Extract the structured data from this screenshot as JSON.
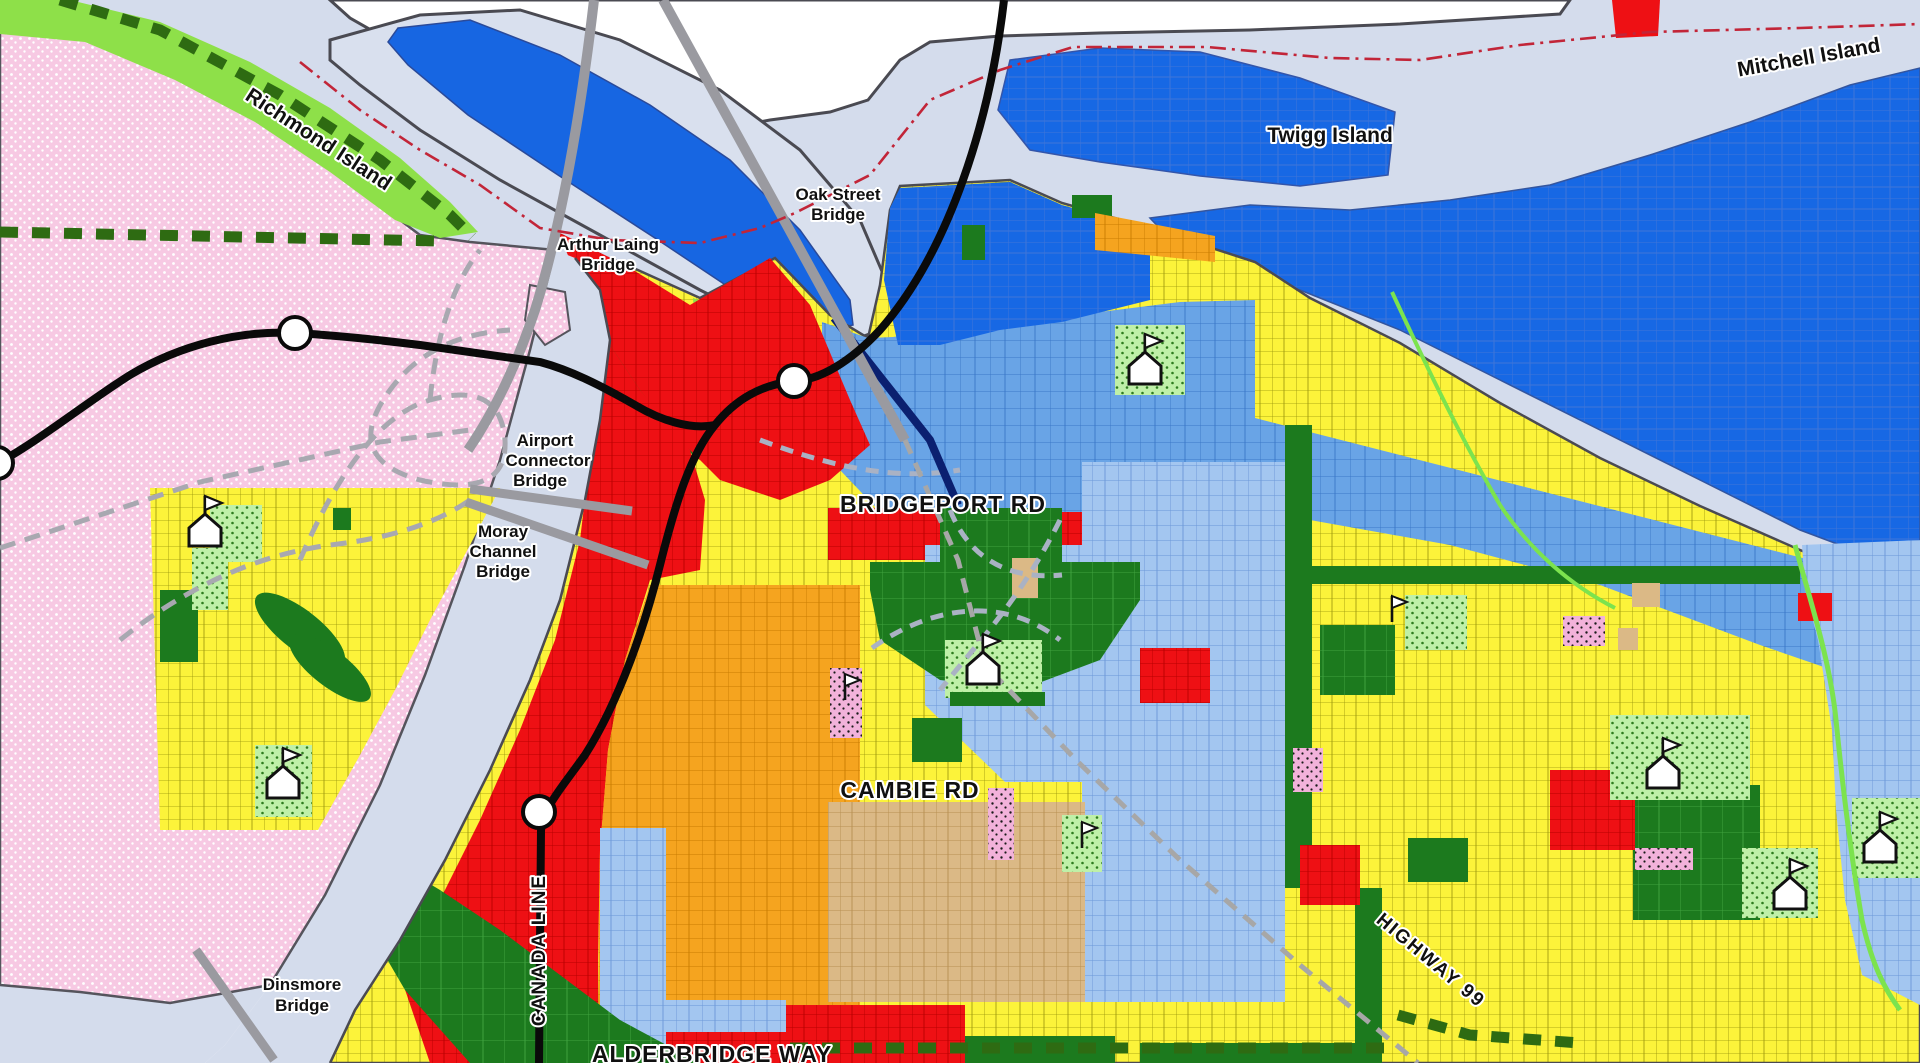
{
  "map": {
    "title": "Bridgeport area zoning map",
    "labels": {
      "richmond_island": "Richmond Island",
      "twigg_island": "Twigg Island",
      "mitchell_island": "Mitchell Island",
      "oak_street_bridge_1": "Oak Street",
      "oak_street_bridge_2": "Bridge",
      "arthur_laing_1": "Arthur Laing",
      "arthur_laing_2": "Bridge",
      "airport_connector_1": "Airport",
      "airport_connector_2": "Connector",
      "airport_connector_3": "Bridge",
      "moray_1": "Moray",
      "moray_2": "Channel",
      "moray_3": "Bridge",
      "dinsmore_1": "Dinsmore",
      "dinsmore_2": "Bridge",
      "bridgeport_rd": "BRIDGEPORT RD",
      "cambie_rd": "CAMBIE RD",
      "canada_line": "CANADA LINE",
      "highway_99": "HIGHWAY 99",
      "alderbridge_way": "ALDERBRIDGE WAY"
    },
    "colors": {
      "water": "#d4dcec",
      "river_white": "#ffffff",
      "shoreline": "#4a4a52",
      "sea_island_pink": "#f7c9e3",
      "greenbelt_bright": "#8ee049",
      "residential_yellow": "#fcf33a",
      "industrial_blue_dark": "#1768e4",
      "mixed_blue_medium": "#69a4e6",
      "residential_blue_light": "#a3c6f0",
      "commercial_red": "#ee1014",
      "industrial_orange": "#f5a41f",
      "tan_zone": "#dbb986",
      "park_green_dark": "#1c7a1e",
      "park_green_dotted": "#bff0a8",
      "pink_dotted": "#f2b2da",
      "transit_black": "#0a0a0a",
      "knight_navy": "#0b2070",
      "bridge_gray": "#9a9aa0",
      "trail_green": "#2e6b12",
      "boundary_red": "#c22538"
    },
    "icons": [
      "school-icon",
      "flag-icon",
      "transit-station-icon"
    ]
  }
}
